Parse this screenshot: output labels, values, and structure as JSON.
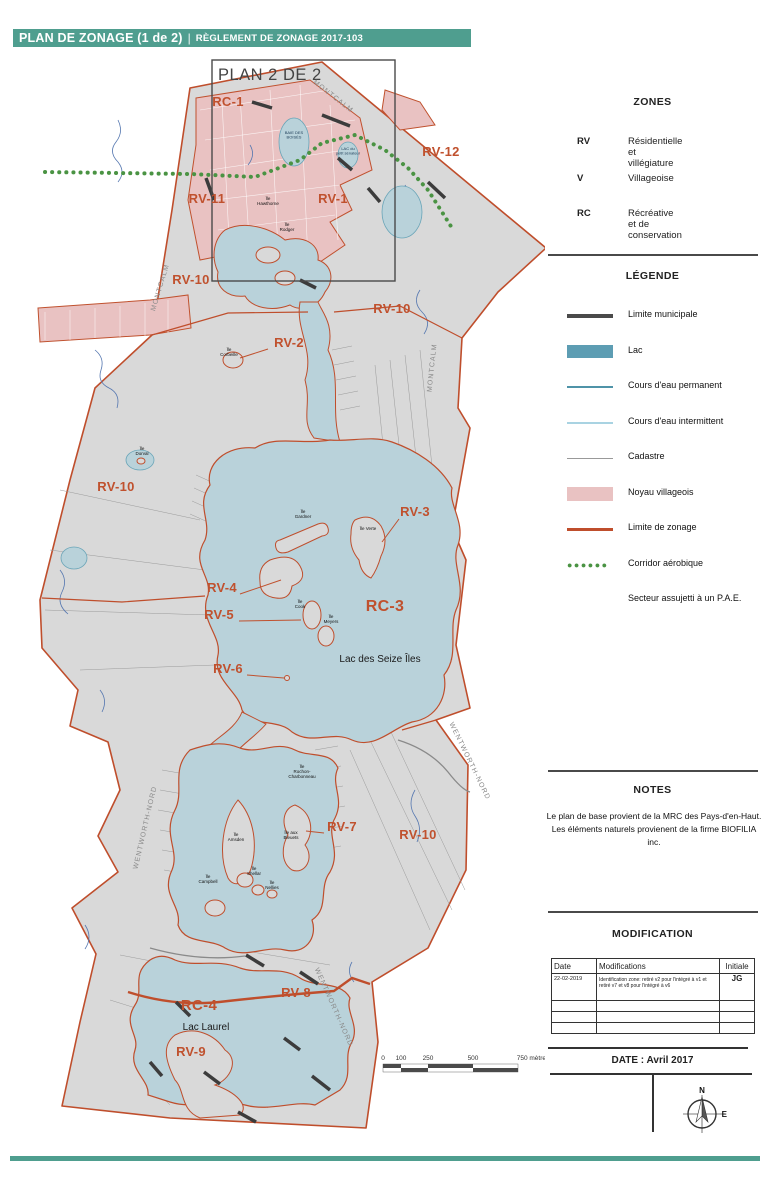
{
  "header": {
    "title": "PLAN DE ZONAGE (1 de 2)",
    "separator": "|",
    "subtitle": "RÈGLEMENT DE ZONAGE 2017-103"
  },
  "colors": {
    "accent_teal": "#4f9e8f",
    "land": "#d9d9d9",
    "water": "#b9d2da",
    "water_stroke": "#6aa5b8",
    "zoning_line": "#bf4e2c",
    "zone_label": "#c0512e",
    "village_pink": "#e9c2c2",
    "corridor_green": "#4a9343",
    "municipal_limit": "#3c3c3c",
    "cadastre": "#9a9a9a",
    "stream": "#5577b0",
    "edge_label": "#8a8a8a"
  },
  "map": {
    "inset": {
      "label": "PLAN 2 DE 2"
    },
    "zone_labels": [
      {
        "text": "RC-1",
        "x": 228,
        "y": 56,
        "size": 13
      },
      {
        "text": "RV-12",
        "x": 441,
        "y": 106,
        "size": 13
      },
      {
        "text": "RV-11",
        "x": 207,
        "y": 153,
        "size": 13
      },
      {
        "text": "RV-1",
        "x": 333,
        "y": 153,
        "size": 13
      },
      {
        "text": "RV-10",
        "x": 191,
        "y": 234,
        "size": 13
      },
      {
        "text": "RV-10",
        "x": 392,
        "y": 263,
        "size": 13
      },
      {
        "text": "RV-2",
        "x": 289,
        "y": 297,
        "size": 13
      },
      {
        "text": "RV-10",
        "x": 116,
        "y": 441,
        "size": 13
      },
      {
        "text": "RV-3",
        "x": 415,
        "y": 466,
        "size": 13
      },
      {
        "text": "RV-4",
        "x": 222,
        "y": 542,
        "size": 13
      },
      {
        "text": "RV-5",
        "x": 219,
        "y": 569,
        "size": 13
      },
      {
        "text": "RC-3",
        "x": 385,
        "y": 561,
        "size": 16
      },
      {
        "text": "RV-6",
        "x": 228,
        "y": 623,
        "size": 13
      },
      {
        "text": "RV-7",
        "x": 342,
        "y": 781,
        "size": 13
      },
      {
        "text": "RV-10",
        "x": 418,
        "y": 789,
        "size": 13
      },
      {
        "text": "RV-8",
        "x": 296,
        "y": 947,
        "size": 13
      },
      {
        "text": "RC-4",
        "x": 199,
        "y": 960,
        "size": 15
      },
      {
        "text": "RV-9",
        "x": 191,
        "y": 1006,
        "size": 13
      }
    ],
    "edge_labels": [
      {
        "text": "MONTCALM",
        "x": 332,
        "y": 48,
        "rotate": 38
      },
      {
        "text": "MONTCALM",
        "x": 162,
        "y": 238,
        "rotate": -73
      },
      {
        "text": "MONTCALM",
        "x": 434,
        "y": 318,
        "rotate": -84
      },
      {
        "text": "WENTWORTH-NORD",
        "x": 147,
        "y": 778,
        "rotate": -77
      },
      {
        "text": "WENTWORTH-NORD",
        "x": 468,
        "y": 712,
        "rotate": 64
      },
      {
        "text": "WENTWORTH-NORD",
        "x": 332,
        "y": 958,
        "rotate": 66
      }
    ],
    "water_labels": [
      {
        "text": "Lac des Seize Îles",
        "x": 380,
        "y": 612,
        "size": 10
      },
      {
        "text": "Lac Laurel",
        "x": 206,
        "y": 980,
        "size": 10
      }
    ],
    "small_water_labels": [
      {
        "lines": [
          "BAIE DES",
          "BOISÉS"
        ],
        "x": 294,
        "y": 84
      },
      {
        "lines": [
          "LAC du",
          "petit sénateur"
        ],
        "x": 348,
        "y": 100
      }
    ],
    "island_labels": [
      {
        "lines": [
          "Île",
          "Hawthorne"
        ],
        "x": 268,
        "y": 150
      },
      {
        "lines": [
          "Île",
          "Rodger"
        ],
        "x": 287,
        "y": 176
      },
      {
        "lines": [
          "Île",
          "Corbeille"
        ],
        "x": 229,
        "y": 301
      },
      {
        "lines": [
          "Île",
          "Dorval"
        ],
        "x": 142,
        "y": 400
      },
      {
        "lines": [
          "Île",
          "Gardner"
        ],
        "x": 303,
        "y": 463
      },
      {
        "lines": [
          "Île Verte"
        ],
        "x": 368,
        "y": 480
      },
      {
        "lines": [
          "Île",
          "Cook"
        ],
        "x": 300,
        "y": 553
      },
      {
        "lines": [
          "Île",
          "Meyers"
        ],
        "x": 331,
        "y": 568
      },
      {
        "lines": [
          "Île",
          "Rochon-",
          "Charbonneau"
        ],
        "x": 302,
        "y": 718
      },
      {
        "lines": [
          "Île",
          "Amsden"
        ],
        "x": 236,
        "y": 786
      },
      {
        "lines": [
          "Île aux",
          "Bleuets"
        ],
        "x": 291,
        "y": 784
      },
      {
        "lines": [
          "Île",
          "Campbell"
        ],
        "x": 208,
        "y": 828
      },
      {
        "lines": [
          "Île",
          "Shellar"
        ],
        "x": 254,
        "y": 820
      },
      {
        "lines": [
          "Île",
          "Nellies"
        ],
        "x": 272,
        "y": 834
      }
    ],
    "scalebar": {
      "ticks": [
        {
          "label": "0",
          "x": 383
        },
        {
          "label": "100",
          "x": 401
        },
        {
          "label": "250",
          "x": 428
        },
        {
          "label": "500",
          "x": 473
        }
      ],
      "end": {
        "label": "750 mètres",
        "x": 533
      }
    }
  },
  "sidebar": {
    "zones": {
      "title": "ZONES",
      "items": [
        {
          "code": "RV",
          "label": "Résidentielle et villégiature"
        },
        {
          "code": "V",
          "label": "Villageoise"
        },
        {
          "code": "RC",
          "label": "Récréative et de conservation"
        }
      ]
    },
    "legend": {
      "title": "LÉGENDE",
      "items": [
        {
          "symbol": "limite-municipale",
          "label": "Limite municipale"
        },
        {
          "symbol": "lac",
          "label": "Lac"
        },
        {
          "symbol": "cours-eau-permanent",
          "label": "Cours d'eau permanent"
        },
        {
          "symbol": "cours-eau-intermittent",
          "label": "Cours d'eau intermittent"
        },
        {
          "symbol": "cadastre",
          "label": "Cadastre"
        },
        {
          "symbol": "noyau-villageois",
          "label": "Noyau villageois"
        },
        {
          "symbol": "limite-de-zonage",
          "label": "Limite de zonage"
        },
        {
          "symbol": "corridor-aerobique",
          "label": "Corridor aérobique"
        },
        {
          "symbol": "none",
          "label": "Secteur assujetti à un P.A.E."
        }
      ]
    },
    "notes": {
      "title": "NOTES",
      "lines": [
        "Le plan de base provient de la MRC des Pays-d'en-Haut.",
        "Les éléments naturels provienent de la firme BIOFILIA inc."
      ]
    },
    "modification": {
      "title": "MODIFICATION",
      "columns": [
        "Date",
        "Modifications",
        "Initiale"
      ],
      "rows": [
        [
          "22-02-2019",
          "Identification zone: retiré v2 pour l'intégré à v1 et retiré v7 et v8 pour l'intégré à v6",
          "JG"
        ],
        [
          "",
          "",
          ""
        ],
        [
          "",
          "",
          ""
        ],
        [
          "",
          "",
          ""
        ]
      ]
    },
    "date": {
      "label": "DATE : Avril 2017"
    },
    "compass": {
      "north": "N",
      "east": "E"
    }
  }
}
